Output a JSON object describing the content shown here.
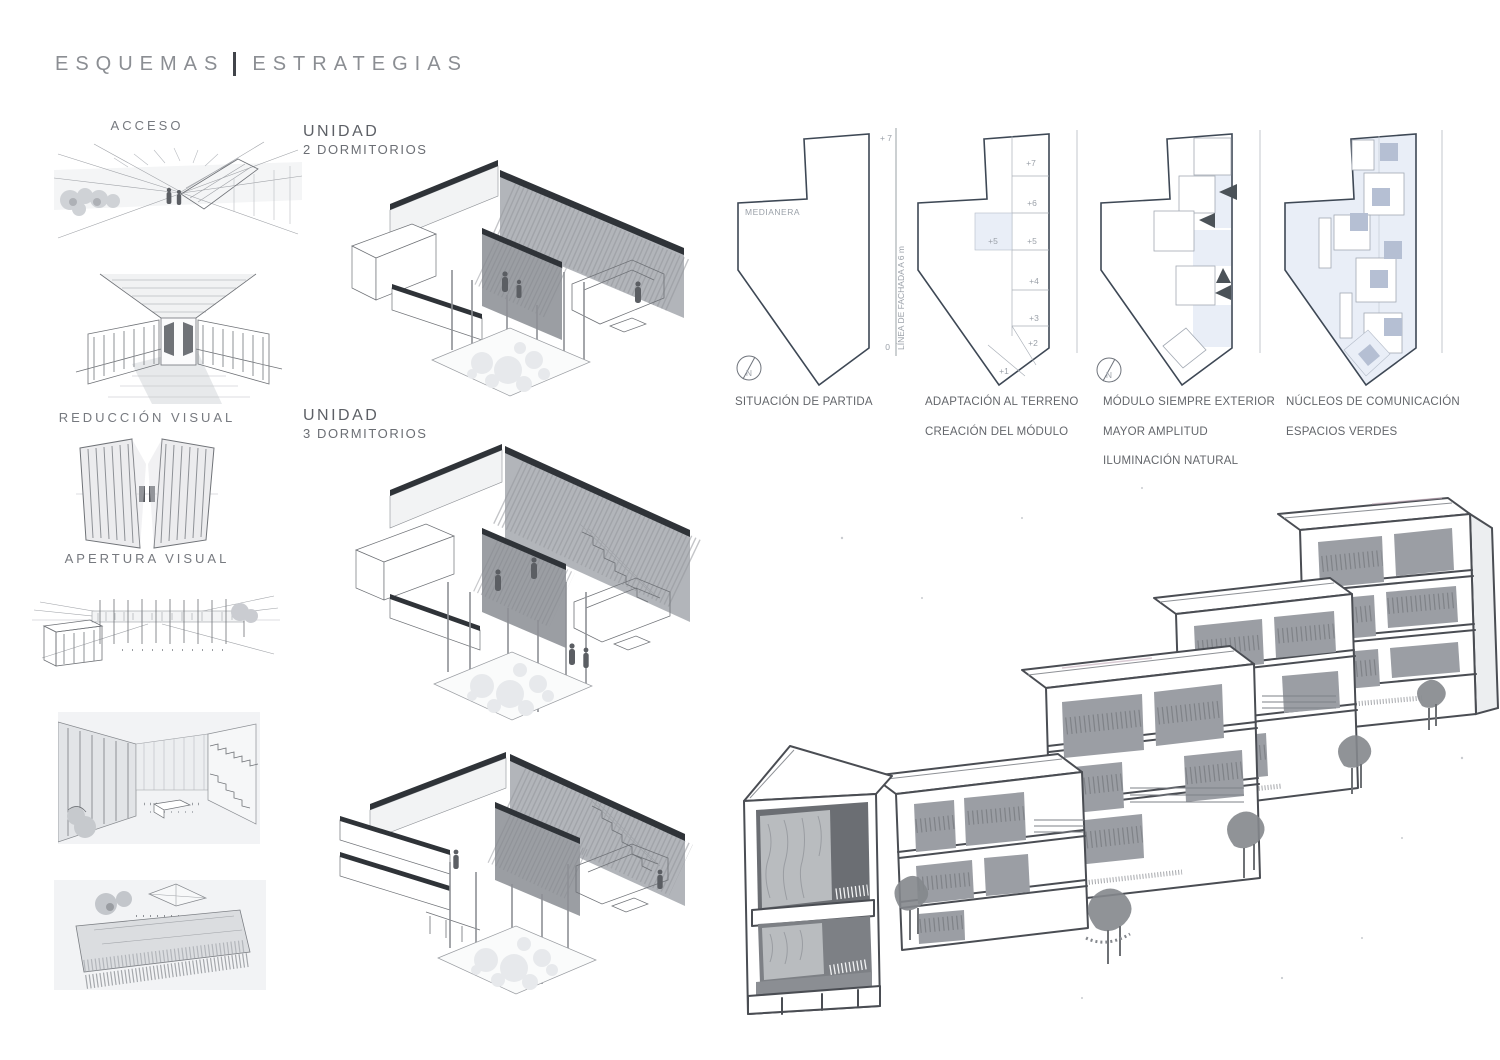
{
  "header": {
    "title_left": "ESQUEMAS",
    "title_right": "ESTRATEGIAS"
  },
  "left_column": {
    "acceso_label": "ACCESO",
    "reduccion_label": "REDUCCIÓN VISUAL",
    "apertura_label": "APERTURA VISUAL"
  },
  "middle_column": {
    "unit1_title": "UNIDAD",
    "unit1_subtitle": "2 DORMITORIOS",
    "unit2_title": "UNIDAD",
    "unit2_subtitle": "3 DORMITORIOS"
  },
  "strategy_row": {
    "panel1": {
      "captions": [
        "SITUACIÓN DE PARTIDA"
      ],
      "medianera_label": "MEDIANERA",
      "level_top": "+ 7",
      "level_zero": "0",
      "facade_axis_label": "LÍNEA DE FACHADA A 6 m",
      "compass_letter": "N"
    },
    "panel2": {
      "captions": [
        "ADAPTACIÓN AL TERRENO",
        "CREACIÓN DEL MÓDULO"
      ],
      "floor_labels": [
        "+7",
        "+6",
        "+5",
        "+4",
        "+3",
        "+2",
        "+1"
      ],
      "module_label": "+5"
    },
    "panel3": {
      "captions": [
        "MÓDULO SIEMPRE EXTERIOR",
        "MAYOR AMPLITUD",
        "ILUMINACIÓN NATURAL"
      ],
      "compass_letter": "N"
    },
    "panel4": {
      "captions": [
        "NÚCLEOS DE COMUNICACIÓN",
        "ESPACIOS VERDES"
      ]
    }
  },
  "colors": {
    "outline": "#3e4855",
    "light_blue": "#e9eef7",
    "module_blue": "#b5bfd3",
    "caption_text": "#63666b",
    "title_text": "#8b8e93"
  }
}
